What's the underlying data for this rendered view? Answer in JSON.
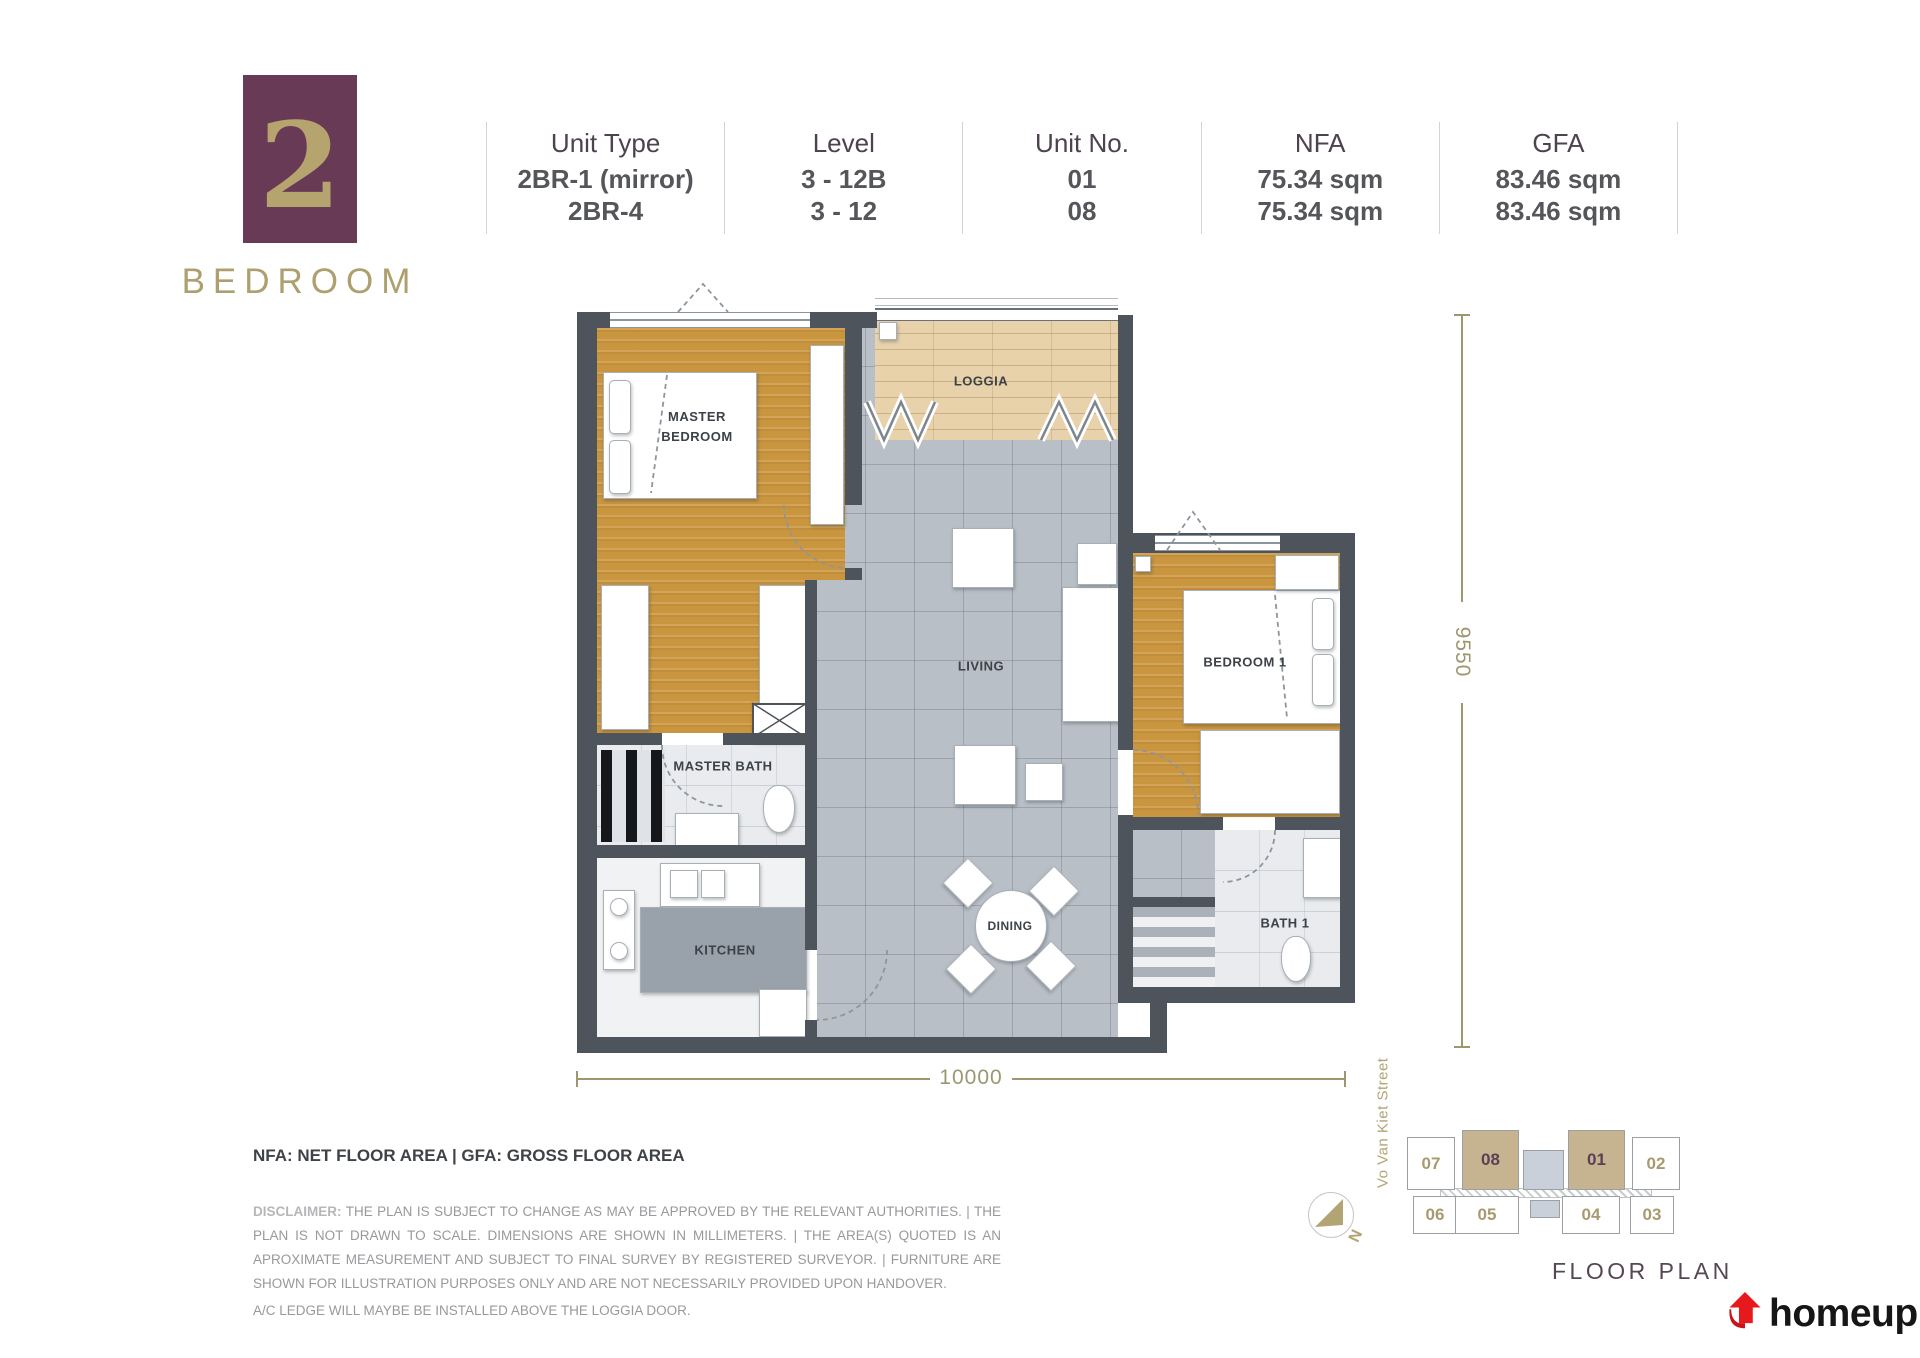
{
  "badge": {
    "number": "2",
    "label": "BEDROOM"
  },
  "unit_table": {
    "columns": [
      {
        "label": "Unit Type",
        "values": [
          "2BR-1 (mirror)",
          "2BR-4"
        ]
      },
      {
        "label": "Level",
        "values": [
          "3 - 12B",
          "3 - 12"
        ]
      },
      {
        "label": "Unit No.",
        "values": [
          "01",
          "08"
        ]
      },
      {
        "label": "NFA",
        "values": [
          "75.34 sqm",
          "75.34 sqm"
        ]
      },
      {
        "label": "GFA",
        "values": [
          "83.46 sqm",
          "83.46 sqm"
        ]
      }
    ]
  },
  "plan": {
    "rooms": {
      "master_bedroom": "MASTER BEDROOM",
      "loggia": "LOGGIA",
      "living": "LIVING",
      "bedroom_1": "BEDROOM 1",
      "master_bath": "MASTER BATH",
      "kitchen": "KITCHEN",
      "dining": "DINING",
      "bath_1": "BATH 1"
    },
    "dimensions": {
      "height_mm": "9550",
      "width_mm": "10000"
    }
  },
  "notes": {
    "area_legend": "NFA: NET FLOOR AREA | GFA: GROSS FLOOR AREA",
    "disclaimer_label": "DISCLAIMER:",
    "disclaimer_body": " THE PLAN IS SUBJECT TO CHANGE AS MAY BE APPROVED BY THE RELEVANT AUTHORITIES. | THE PLAN IS NOT DRAWN TO SCALE. DIMENSIONS ARE SHOWN IN MILLIMETERS. | THE AREA(S) QUOTED IS AN APROXIMATE MEASUREMENT AND SUBJECT TO FINAL SURVEY BY REGISTERED SURVEYOR. | FURNITURE ARE SHOWN FOR ILLUSTRATION PURPOSES ONLY AND ARE NOT NECESSARILY  PROVIDED UPON HANDOVER.",
    "ac_note": "A/C LEDGE WILL MAYBE BE INSTALLED ABOVE THE LOGGIA DOOR."
  },
  "key_plan": {
    "street": "Vo Van Kiet Street",
    "compass": "N",
    "title": "FLOOR PLAN",
    "units_top": [
      {
        "no": "07",
        "highlighted": false
      },
      {
        "no": "08",
        "highlighted": true
      },
      {
        "no": "01",
        "highlighted": true
      },
      {
        "no": "02",
        "highlighted": false
      }
    ],
    "units_bottom": [
      {
        "no": "06"
      },
      {
        "no": "05"
      },
      {
        "no": "04"
      },
      {
        "no": "03"
      }
    ]
  },
  "brand": {
    "name": "homeup"
  }
}
